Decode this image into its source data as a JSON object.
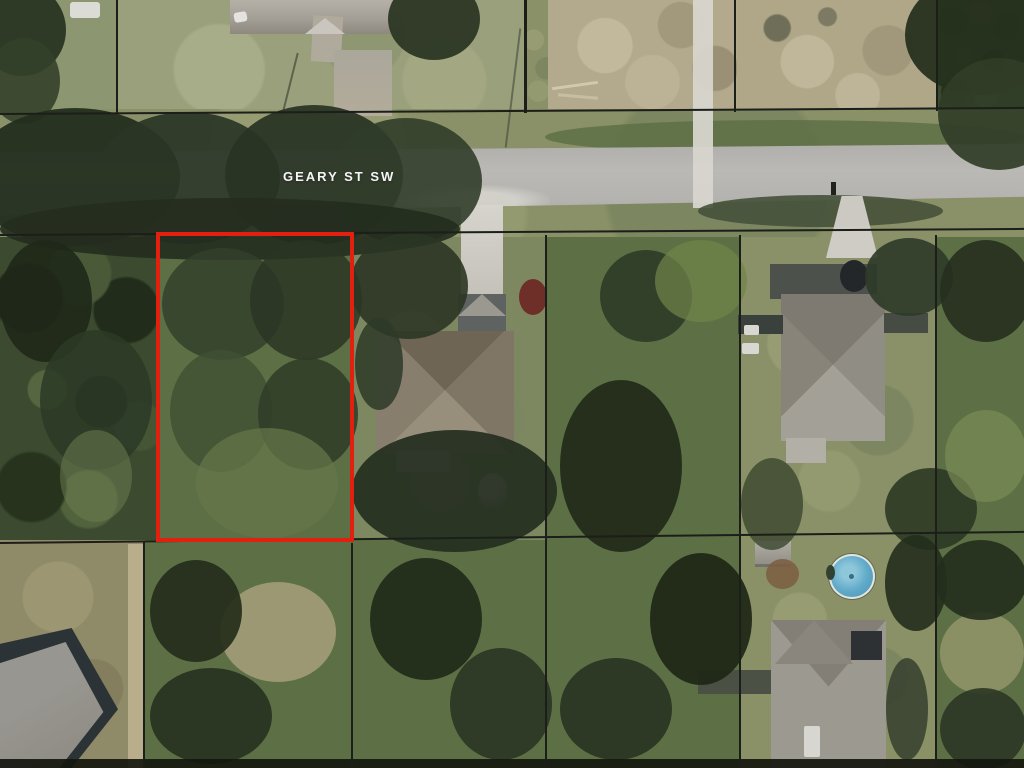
{
  "map": {
    "street_label": "GEARY ST SW"
  },
  "colors": {
    "parcel-line": "#1c1e19",
    "highlight-outline": "#e2200f",
    "road-surface": "#b6b5b1",
    "street-label": "#f5f5f3",
    "pool-water": "#5fa9c9",
    "dirt-ground": "#b3a98d",
    "grass-ground": "#87916c"
  }
}
